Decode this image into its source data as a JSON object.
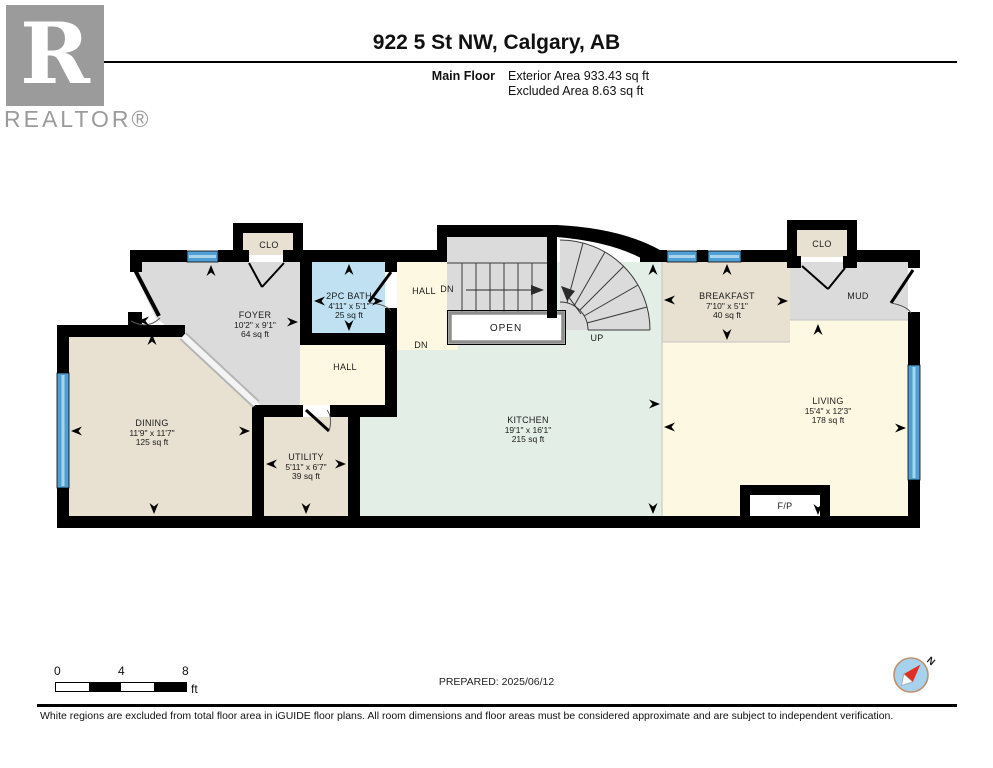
{
  "header": {
    "logo_letter": "R",
    "logo_text": "REALTOR®",
    "title": "922 5 St NW, Calgary, AB",
    "floor_label": "Main Floor",
    "area_line1": "Exterior Area 933.43 sq ft",
    "area_line2": "Excluded Area 8.63 sq ft"
  },
  "plan": {
    "rooms": {
      "foyer": {
        "name": "FOYER",
        "dims": "10'2\" x 9'1\"",
        "area": "64 sq ft"
      },
      "bath": {
        "name": "2PC BATH",
        "dims": "4'11\" x 5'1\"",
        "area": "25 sq ft"
      },
      "dining": {
        "name": "DINING",
        "dims": "11'9\" x 11'7\"",
        "area": "125 sq ft"
      },
      "utility": {
        "name": "UTILITY",
        "dims": "5'11\" x 6'7\"",
        "area": "39 sq ft"
      },
      "kitchen": {
        "name": "KITCHEN",
        "dims": "19'1\" x 16'1\"",
        "area": "215 sq ft"
      },
      "breakfast": {
        "name": "BREAKFAST",
        "dims": "7'10\" x 5'1\"",
        "area": "40 sq ft"
      },
      "living": {
        "name": "LIVING",
        "dims": "15'4\" x 12'3\"",
        "area": "178 sq ft"
      }
    },
    "labels": {
      "clo_left": "CLO",
      "clo_right": "CLO",
      "hall_upper": "HALL",
      "hall_lower": "HALL",
      "mud": "MUD",
      "open": "OPEN",
      "up": "UP",
      "dn_upper": "DN",
      "dn_lower": "DN",
      "fireplace": "F/P"
    },
    "colors": {
      "wall": "#000000",
      "beige": "#e8e0d1",
      "gray": "#dbdbdb",
      "cream": "#fdf8e1",
      "bath_blue": "#bfe1f2",
      "kitchen_mint": "#e3eee7",
      "window": "#4d9fd6",
      "window_stripe": "#a9d4ec"
    }
  },
  "footer": {
    "scale": {
      "tick0": "0",
      "tick4": "4",
      "tick8": "8",
      "unit": "ft"
    },
    "prepared": "PREPARED: 2025/06/12",
    "compass_label": "N",
    "disclaimer": "White regions are excluded from total floor area in iGUIDE floor plans. All room dimensions and floor areas must be considered approximate and are subject to independent verification."
  }
}
